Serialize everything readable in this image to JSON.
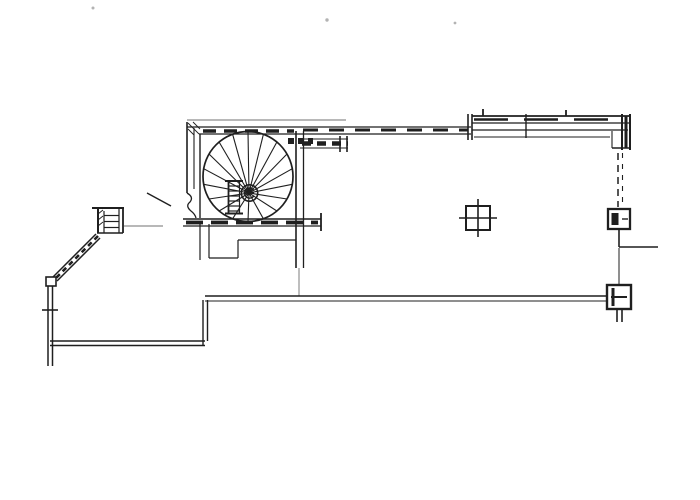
{
  "meta": {
    "kind": "scanned architectural floor plan drawing",
    "visible_text": "none (line drawing only)"
  },
  "colors": {
    "paper": "#ffffff",
    "ink": "#1f1f1f",
    "ink_light": "#707070",
    "speck": "#b3b3b3"
  },
  "staircase": {
    "circle_cx": 248,
    "circle_cy": 176.5,
    "radius": 45,
    "newel_x": 249,
    "newel_y": 193,
    "tread_count": 18
  },
  "components": {
    "spiral_staircase": "circular stair with radial treads and centre newel",
    "stair_room": "square stairwell enclosure with hatched walls",
    "stair_ladder": "ladder symbol inside stairwell",
    "hoist_circle_symbol": "small circle symbol at stair newel",
    "entry_steps": "stepped landing below stairwell",
    "top_wall": "upper corridor wall with dashed fill",
    "top_wall_thick": "upper-right multi-line wall run",
    "top_right_corner": "wall corner block upper right",
    "right_wall_dashed": "dashed wall line on right side",
    "column_upper_right": "column block on right wall",
    "column_lower_right": "column block at bottom wall end",
    "column_marker_mid": "crossed-square column marker mid plan",
    "right_stub_wall": "short wall stub to right edge",
    "left_post": "small pier/post detail on left",
    "leader_line": "thin leader line from left post",
    "door_swing_line": "door leaf line at stair room entry",
    "diagonal_wall": "angled hatched wall to lower left",
    "wall_joint": "small joint box at wall angle",
    "left_wall": "left vertical wall with tick",
    "lower_left_wall": "lower-left horizontal wall",
    "step_corner_wall": "vertical jog joining bottom walls",
    "bottom_long_wall": "long bottom wall",
    "specks": "scanner dust specks"
  }
}
